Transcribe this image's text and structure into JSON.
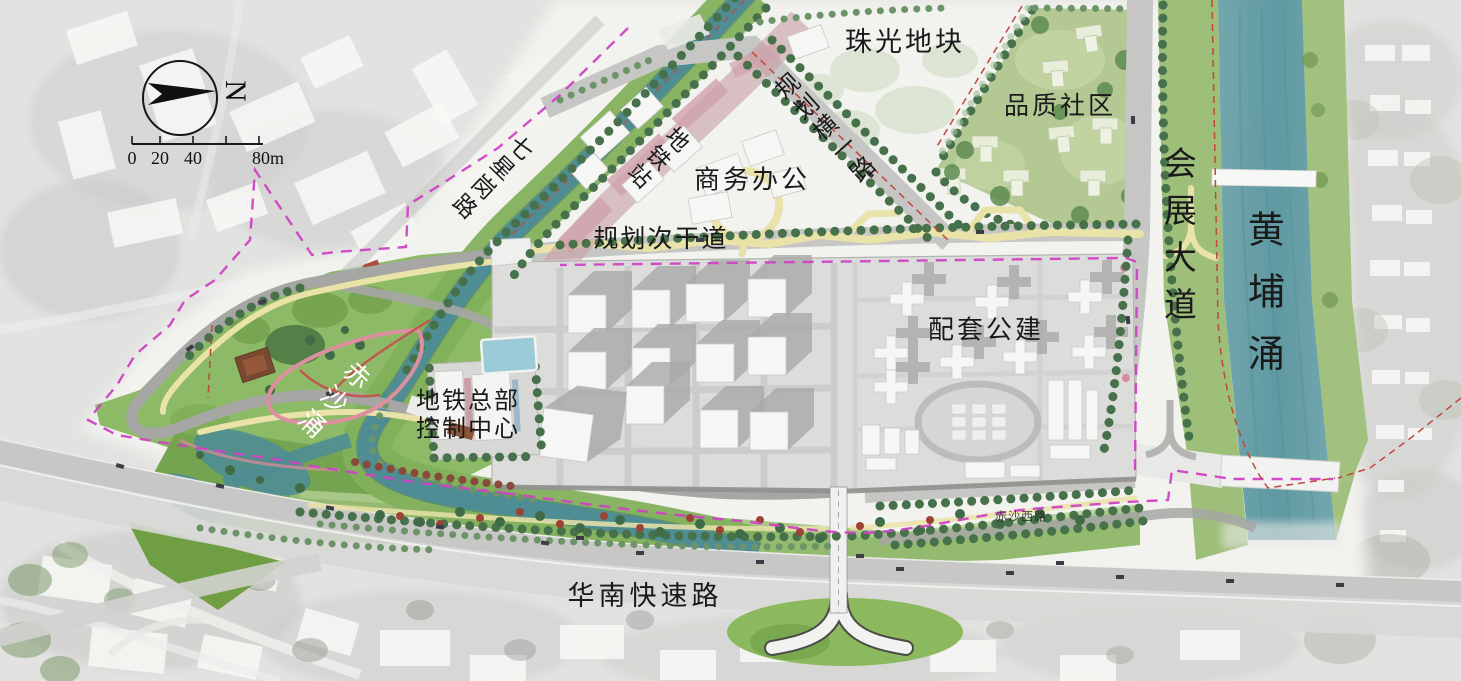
{
  "map": {
    "region_labels": {
      "zhuguang_plot": "珠光地块",
      "quality_community": "品质社区",
      "business_office": "商务办公",
      "supporting_public": "配套公建",
      "metro_hq_line1": "地铁总部",
      "metro_hq_line2": "控制中心",
      "metro_station": "地铁站"
    },
    "road_labels": {
      "planned_heng_yi_road": "规划横一路",
      "planned_secondary_road": "规划次干道",
      "qixinggang_road": "七星岗路",
      "exhibition_avenue": "会展大道",
      "south_china_expressway": "华南快速路",
      "chisha_west_road": "赤沙西路"
    },
    "water_labels": {
      "huangpu_chong": "黄埔涌",
      "chisha_chong": "赤沙涌"
    },
    "compass": {
      "north_label": "N"
    },
    "scale_bar": {
      "labels": [
        "0",
        "20",
        "40",
        "80m"
      ]
    },
    "colors": {
      "water_teal": "#4f8d94",
      "huangpu_teal": "#6aa4ab",
      "park_green": "#8dba66",
      "community_green": "#b3c893",
      "metro_corridor_pink": "#c79fa6",
      "platform_gray": "#dcdcda",
      "boundary_magenta": "#cf42c4",
      "road_red_line": "#c0473c",
      "greenway_yellow": "#e9e2a9"
    }
  }
}
